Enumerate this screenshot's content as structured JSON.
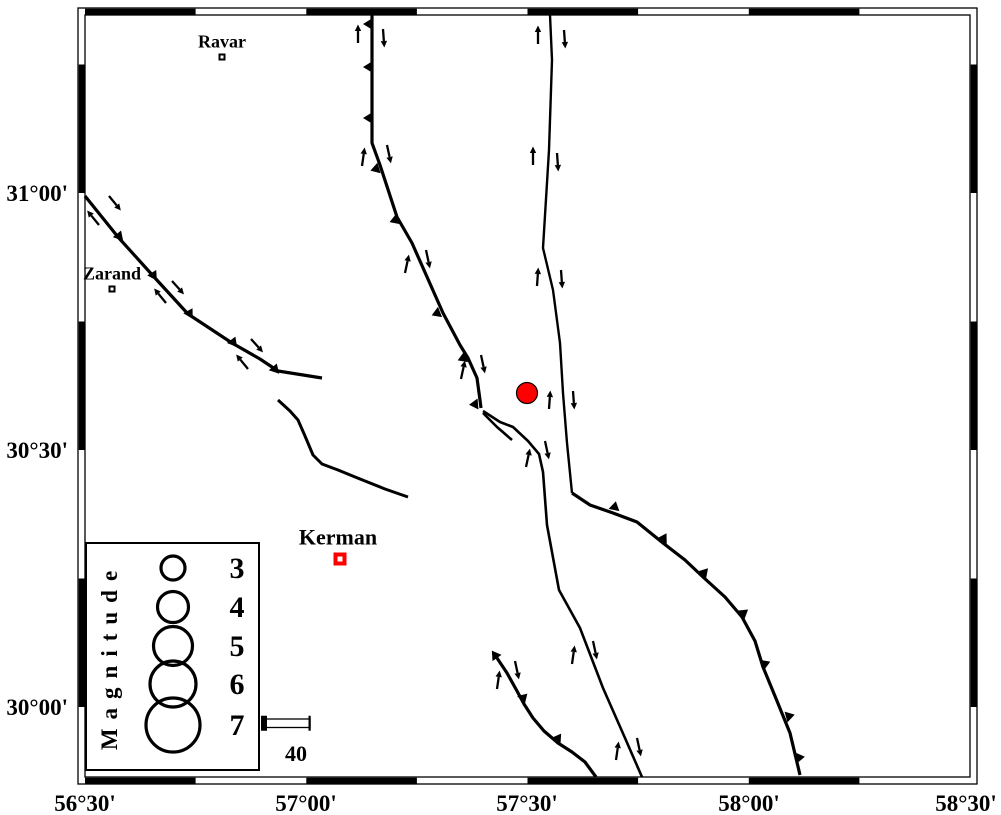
{
  "figure": {
    "background": "#ffffff",
    "frame": {
      "outer": {
        "x": 78,
        "y": 8,
        "w": 899,
        "h": 776
      },
      "inner": {
        "x": 85,
        "y": 15,
        "w": 885,
        "h": 762
      },
      "band": 6.3,
      "x_boundaries": [
        85,
        195.6,
        306.3,
        416.9,
        527.5,
        638.1,
        748.8,
        859.4,
        970
      ],
      "x_first_black": true,
      "y_boundaries": [
        15,
        64.5,
        193,
        321.5,
        450,
        578.5,
        707,
        777
      ],
      "y_first_black": false,
      "line_color": "#000000"
    },
    "x_axis": {
      "label_baseline_y": 811,
      "font_size": 23,
      "ticks": [
        {
          "label": "56°30'",
          "x": 85
        },
        {
          "label": "57°00'",
          "x": 306
        },
        {
          "label": "57°30'",
          "x": 527
        },
        {
          "label": "58°00'",
          "x": 749
        },
        {
          "label": "58°30'",
          "x": 966
        }
      ]
    },
    "y_axis": {
      "label_right_x": 68,
      "font_size": 23,
      "ticks": [
        {
          "label": "31°00'",
          "y": 193
        },
        {
          "label": "30°30'",
          "y": 450
        },
        {
          "label": "30°00'",
          "y": 707
        }
      ]
    },
    "cities": [
      {
        "name": "Ravar",
        "x": 222,
        "y": 57,
        "size": 7,
        "color": "#000000",
        "label_dx": 0,
        "label_dy": -12,
        "font_size": 18
      },
      {
        "name": "Zarand",
        "x": 112,
        "y": 289,
        "size": 7,
        "color": "#000000",
        "label_dx": 0,
        "label_dy": -12,
        "font_size": 18
      },
      {
        "name": "Kerman",
        "x": 340,
        "y": 559,
        "size": 13,
        "color": "#ff0000",
        "label_dx": -2,
        "label_dy": -14,
        "font_size": 22
      }
    ],
    "epicenter": {
      "x": 527,
      "y": 393,
      "r": 10.5,
      "fill": "#ff0000",
      "stroke": "#000000"
    },
    "faults": [
      {
        "name": "kuh-banan-fault",
        "width": 3.2,
        "points": [
          [
            85,
            196
          ],
          [
            118,
            237
          ],
          [
            155,
            278
          ],
          [
            188,
            314
          ],
          [
            232,
            343
          ],
          [
            260,
            359
          ],
          [
            278,
            371
          ],
          [
            322,
            378
          ]
        ],
        "teeth": [
          [
            118,
            239,
            -70
          ],
          [
            152,
            278,
            -62
          ],
          [
            188,
            316,
            -60
          ],
          [
            232,
            345,
            -68
          ],
          [
            274,
            372,
            -72
          ]
        ]
      },
      {
        "name": "short-curved-fault",
        "width": 3,
        "points": [
          [
            278,
            400
          ],
          [
            290,
            411
          ],
          [
            298,
            420
          ],
          [
            305,
            436
          ],
          [
            313,
            455
          ],
          [
            322,
            464
          ],
          [
            338,
            470
          ],
          [
            360,
            479
          ],
          [
            385,
            489
          ],
          [
            408,
            497
          ]
        ],
        "teeth": []
      },
      {
        "name": "west-central-fault",
        "width": 3.2,
        "points": [
          [
            372,
            15
          ],
          [
            372,
            143
          ],
          [
            380,
            165
          ],
          [
            397,
            217
          ],
          [
            412,
            243
          ],
          [
            443,
            313
          ],
          [
            460,
            345
          ],
          [
            468,
            358
          ],
          [
            477,
            378
          ],
          [
            480,
            400
          ],
          [
            481,
            408
          ]
        ],
        "teeth": [
          [
            372,
            24,
            180
          ],
          [
            372,
            67,
            180
          ],
          [
            372,
            118,
            180
          ],
          [
            379,
            168,
            163
          ],
          [
            398,
            219,
            160
          ],
          [
            440,
            312,
            158
          ],
          [
            466,
            357,
            158
          ],
          [
            478,
            404,
            175
          ]
        ]
      },
      {
        "name": "splay-segment",
        "width": 2.6,
        "points": [
          [
            483,
            413
          ],
          [
            497,
            427
          ],
          [
            512,
            440
          ]
        ],
        "teeth": []
      },
      {
        "name": "central-fault",
        "width": 2.6,
        "points": [
          [
            483,
            411
          ],
          [
            500,
            422
          ],
          [
            513,
            427
          ],
          [
            528,
            441
          ],
          [
            539,
            454
          ],
          [
            543,
            472
          ],
          [
            547,
            525
          ],
          [
            559,
            590
          ],
          [
            580,
            628
          ],
          [
            603,
            688
          ],
          [
            625,
            738
          ],
          [
            642,
            777
          ]
        ],
        "teeth": []
      },
      {
        "name": "northeast-fault",
        "width": 2.4,
        "points": [
          [
            550,
            15
          ],
          [
            552,
            60
          ],
          [
            549,
            150
          ],
          [
            543,
            248
          ],
          [
            553,
            290
          ],
          [
            560,
            343
          ],
          [
            563,
            393
          ],
          [
            567,
            443
          ],
          [
            572,
            493
          ]
        ],
        "teeth": []
      },
      {
        "name": "eastern-arc-fault",
        "width": 3.2,
        "points": [
          [
            572,
            493
          ],
          [
            590,
            505
          ],
          [
            613,
            513
          ],
          [
            637,
            522
          ],
          [
            663,
            543
          ],
          [
            685,
            560
          ],
          [
            703,
            577
          ],
          [
            725,
            597
          ],
          [
            742,
            617
          ],
          [
            755,
            641
          ],
          [
            763,
            667
          ],
          [
            777,
            701
          ],
          [
            790,
            733
          ],
          [
            800,
            775
          ]
        ],
        "teeth": [
          [
            614,
            510,
            -78
          ],
          [
            662,
            541,
            -60
          ],
          [
            702,
            575,
            -48
          ],
          [
            741,
            615,
            -38
          ],
          [
            762,
            665,
            -22
          ],
          [
            786,
            717,
            -15
          ],
          [
            796,
            758,
            -8
          ]
        ]
      },
      {
        "name": "southwest-fault",
        "width": 3.2,
        "points": [
          [
            495,
            655
          ],
          [
            507,
            673
          ],
          [
            517,
            691
          ],
          [
            524,
            704
          ],
          [
            533,
            718
          ],
          [
            544,
            731
          ],
          [
            558,
            743
          ],
          [
            572,
            752
          ],
          [
            585,
            762
          ],
          [
            596,
            777
          ]
        ],
        "teeth": [
          [
            497,
            658,
            235
          ],
          [
            521,
            700,
            -45
          ],
          [
            556,
            741,
            -55
          ]
        ]
      }
    ],
    "slip_arrows": [
      [
        109,
        196,
        118,
        207
      ],
      [
        99,
        225,
        90,
        214
      ],
      [
        172,
        281,
        181,
        291
      ],
      [
        166,
        303,
        157,
        292
      ],
      [
        251,
        339,
        260,
        349
      ],
      [
        248,
        369,
        239,
        358
      ],
      [
        358,
        43,
        358,
        29
      ],
      [
        383,
        29,
        384,
        43
      ],
      [
        362,
        166,
        364,
        152
      ],
      [
        387,
        145,
        390,
        159
      ],
      [
        405,
        273,
        408,
        259
      ],
      [
        426,
        250,
        429,
        264
      ],
      [
        461,
        379,
        464,
        365
      ],
      [
        481,
        355,
        484,
        369
      ],
      [
        526,
        467,
        529,
        453
      ],
      [
        545,
        441,
        548,
        455
      ],
      [
        538,
        44,
        538,
        30
      ],
      [
        564,
        30,
        565,
        44
      ],
      [
        533,
        165,
        533,
        151
      ],
      [
        557,
        153,
        558,
        167
      ],
      [
        537,
        286,
        538,
        272
      ],
      [
        561,
        270,
        562,
        284
      ],
      [
        549,
        409,
        550,
        395
      ],
      [
        573,
        391,
        574,
        405
      ],
      [
        572,
        664,
        574,
        650
      ],
      [
        593,
        641,
        596,
        655
      ],
      [
        616,
        760,
        618,
        746
      ],
      [
        637,
        738,
        640,
        752
      ],
      [
        497,
        689,
        499,
        675
      ],
      [
        515,
        661,
        518,
        675
      ]
    ],
    "legend": {
      "box": {
        "x": 86,
        "y": 543,
        "w": 173,
        "h": 227
      },
      "title": "Magnitude",
      "title_x": 117,
      "title_cy": 656,
      "title_font": 23,
      "title_spacing": 9,
      "circle_cx": 173,
      "circle_stroke": 3.2,
      "label_x": 237,
      "label_font": 30,
      "entries": [
        {
          "mag": "3",
          "cy": 568,
          "r": 12
        },
        {
          "mag": "4",
          "cy": 607,
          "r": 15.5
        },
        {
          "mag": "5",
          "cy": 646,
          "r": 19.5
        },
        {
          "mag": "6",
          "cy": 684,
          "r": 23
        },
        {
          "mag": "7",
          "cy": 725,
          "r": 27
        }
      ]
    },
    "scalebar": {
      "x1": 262,
      "x2": 310,
      "y_top": 719,
      "h": 8.5,
      "cap_w": 6,
      "cap_h": 15,
      "label": "40",
      "label_x": 296,
      "label_y": 761,
      "font": 22
    }
  }
}
